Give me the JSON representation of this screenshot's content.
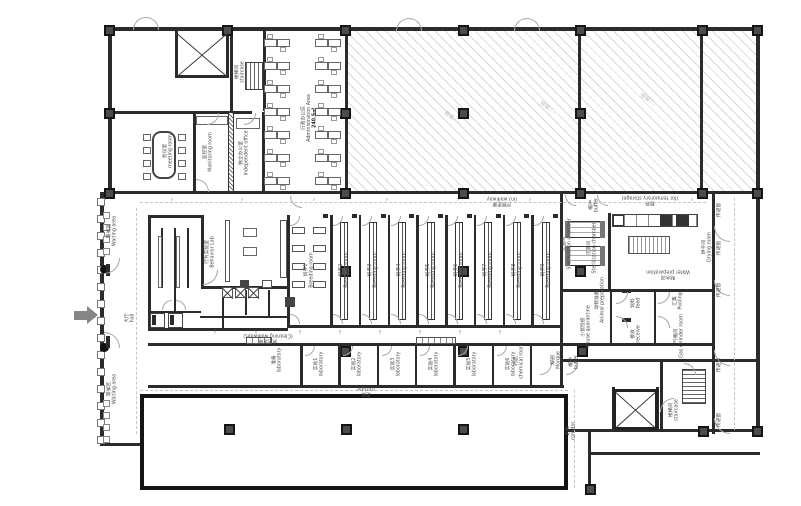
{
  "plan": {
    "colors": {
      "wall": "#2b2b2b",
      "hatch_line": "#d8d8d8",
      "label": "#4a4a4a",
      "arrow": "#868686",
      "column": "#4c4c4c"
    },
    "breeding": {
      "en": "Breeding room",
      "rooms": [
        "饲养1",
        "饲养2",
        "饲养3",
        "饲养4",
        "饲养5",
        "饲养6",
        "饲养7",
        "饲养8",
        "饲养9"
      ]
    },
    "labs": {
      "en": "laboratory",
      "rooms": [
        "实验1",
        "实验2",
        "实验3",
        "实验4",
        "实验5",
        "实验6"
      ]
    },
    "reserved": {
      "text": "预留 ⁄…",
      "marks": [
        {
          "x": 452,
          "y": 118
        },
        {
          "x": 548,
          "y": 108
        },
        {
          "x": 648,
          "y": 100
        }
      ]
    },
    "labels": [
      {
        "zh": "会议室",
        "en": "meeting room",
        "x": 168,
        "y": 151,
        "r": -90
      },
      {
        "zh": "监控室",
        "en": "Monitoring room",
        "x": 208,
        "y": 152,
        "r": -90
      },
      {
        "zh": "楼梯间",
        "en": "staircase",
        "x": 240,
        "y": 72,
        "r": -90
      },
      {
        "zh": "独立办公室",
        "en": "Independent office",
        "x": 244,
        "y": 153,
        "r": -90
      },
      {
        "zh": "行政办公区",
        "en": "Administration Area",
        "x": 309,
        "y": 118,
        "r": -90,
        "b": "240.5㎡"
      },
      {
        "zh": "污物走廊",
        "en": "(in) walkway",
        "x": 502,
        "y": 201,
        "r": 180
      },
      {
        "zh": "暂存",
        "en": "(for temporary storage)",
        "x": 650,
        "y": 200,
        "r": 180
      },
      {
        "zh": "等候区",
        "en": "Waiting area",
        "x": 112,
        "y": 231,
        "r": -90
      },
      {
        "zh": "等候区",
        "en": "Waiting area",
        "x": 112,
        "y": 389,
        "r": -90
      },
      {
        "zh": "大厅",
        "en": "hall",
        "x": 130,
        "y": 318,
        "r": -90
      },
      {
        "zh": "行为实验室",
        "en": "Behavior Lab",
        "x": 210,
        "y": 252,
        "r": -90
      },
      {
        "zh": "清洁走廊",
        "en": "(Cleaning walkways)",
        "x": 268,
        "y": 338,
        "r": 180
      },
      {
        "zh": "灭菌间",
        "en": "Sterilization chamber",
        "x": 567,
        "y": 244,
        "r": -90
      },
      {
        "zh": "灭菌间",
        "en": "Sterilization chamber",
        "x": 592,
        "y": 248,
        "r": -90
      },
      {
        "zh": "制水间",
        "en": "Water preparation",
        "x": 668,
        "y": 274,
        "r": 180
      },
      {
        "zh": "烘干间",
        "en": "Drying room",
        "x": 707,
        "y": 247,
        "r": -90
      },
      {
        "zh": "缓冲",
        "en": "buffer",
        "x": 594,
        "y": 205,
        "r": -90
      },
      {
        "zh": "小鼠检疫",
        "en": "Mouse quarantine",
        "x": 586,
        "y": 327,
        "r": -90
      },
      {
        "zh": "动物准备",
        "en": "Animal preparation",
        "x": 600,
        "y": 300,
        "r": -90
      },
      {
        "zh": "饲料",
        "en": "feed",
        "x": 636,
        "y": 303,
        "r": -90
      },
      {
        "zh": "接收",
        "en": "receive",
        "x": 636,
        "y": 334,
        "r": -90
      },
      {
        "zh": "汇集",
        "en": "Pooling",
        "x": 678,
        "y": 301,
        "r": -90
      },
      {
        "zh": "气瓶间",
        "en": "Gas cylinder room",
        "x": 679,
        "y": 336,
        "r": -90
      },
      {
        "zh": "楼梯间",
        "en": "staircase",
        "x": 674,
        "y": 410,
        "r": -90
      },
      {
        "zh": "走廊",
        "en": "corridor",
        "x": 366,
        "y": 391,
        "r": 180
      },
      {
        "zh": "走廊",
        "en": "corridor",
        "x": 571,
        "y": 431,
        "r": -90
      },
      {
        "zh": "药品",
        "en": "chemical room",
        "x": 519,
        "y": 361,
        "r": -90
      },
      {
        "zh": "解剖",
        "en": "Morgue",
        "x": 556,
        "y": 360,
        "r": -90
      },
      {
        "zh": "缓冲",
        "en": "buffer",
        "x": 574,
        "y": 362,
        "r": -90
      },
      {
        "zh": "准备",
        "en": "laboratory",
        "x": 277,
        "y": 360,
        "r": -90
      },
      {
        "zh": "传递窗",
        "en": "",
        "x": 719,
        "y": 210,
        "r": -90
      },
      {
        "zh": "传递窗",
        "en": "",
        "x": 719,
        "y": 248,
        "r": -90
      },
      {
        "zh": "传递窗",
        "en": "",
        "x": 719,
        "y": 290,
        "r": -90
      },
      {
        "zh": "传递窗",
        "en": "",
        "x": 719,
        "y": 365,
        "r": -90
      },
      {
        "zh": "传递窗",
        "en": "",
        "x": 719,
        "y": 420,
        "r": -90
      }
    ]
  }
}
